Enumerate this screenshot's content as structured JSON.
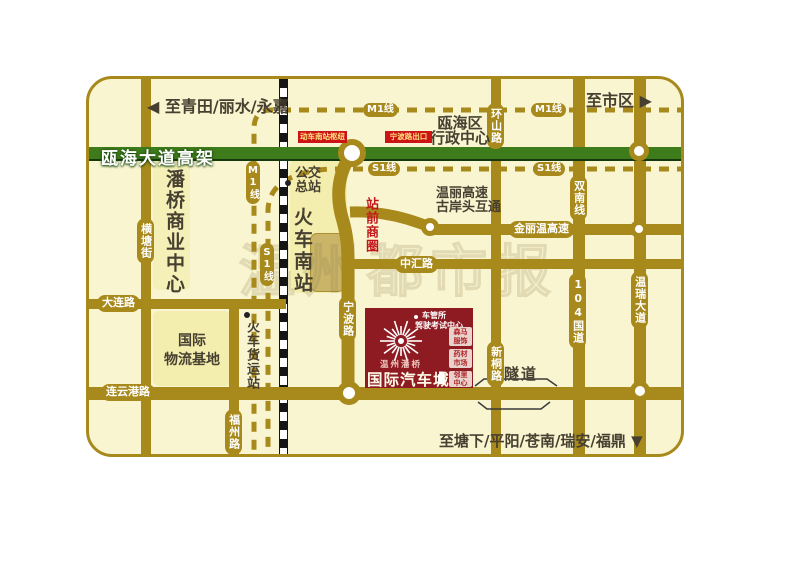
{
  "map": {
    "watermark": "温州都市报",
    "icons": {
      "left": "◀",
      "right": "▶",
      "down": "▼"
    },
    "directions": {
      "northwest": "至青田/丽水/永嘉",
      "northeast": "至市区",
      "south": "至塘下/平阳/苍南/瑞安/福鼎"
    },
    "metro": {
      "m1": "M1线",
      "s1": "S1线"
    },
    "roads": {
      "ouhai_elevated": "瓯海大道高架",
      "hengtang": "横塘街",
      "dalian": "大连路",
      "lianyungang": "连云港路",
      "fuzhou": "福州路",
      "ningbo": "宁波路",
      "zhonghui": "中汇路",
      "jinliwen": "金丽温高速",
      "huanshan": "环山路",
      "xintong": "新桐路",
      "shuangnan": "双南线",
      "g104": "104国道",
      "wenrui": "温瑞大道",
      "tunnel": "隧道"
    },
    "areas": {
      "panqiao_business": "潘桥商业中心",
      "logistics_l1": "国际",
      "logistics_l2": "物流基地",
      "admin_l1": "瓯海区",
      "admin_l2": "行政中心",
      "wenli_l1": "温丽高速",
      "wenli_l2": "古岸头互通",
      "zhanqian": "站前商圈",
      "south_station": "火车南站"
    },
    "pois": {
      "bus_l1": "公交",
      "bus_l2": "总站",
      "freight_station": "火车货运站",
      "hub_label": "动车南站枢纽",
      "ningbo_exit": "宁波路出口"
    },
    "project": {
      "brand": "温州潘桥",
      "name": "国际汽车城",
      "dmv_l1": "车管所",
      "dmv_l2": "驾驶考试中心",
      "tenants": [
        {
          "l1": "森马",
          "l2": "服饰"
        },
        {
          "l1": "药材",
          "l2": "市场"
        },
        {
          "l1": "邻里",
          "l2": "中心"
        }
      ]
    },
    "colors": {
      "road": "#a8891c",
      "elevated_green": "#3e7c1b",
      "map_background": "#f9f5d1",
      "block": "#f3edae",
      "project_red": "#8e1b22",
      "red_text": "#c3161b",
      "tag_red": "#cc1416",
      "dark_text": "#474031",
      "station_tan": "#c9b468"
    }
  }
}
